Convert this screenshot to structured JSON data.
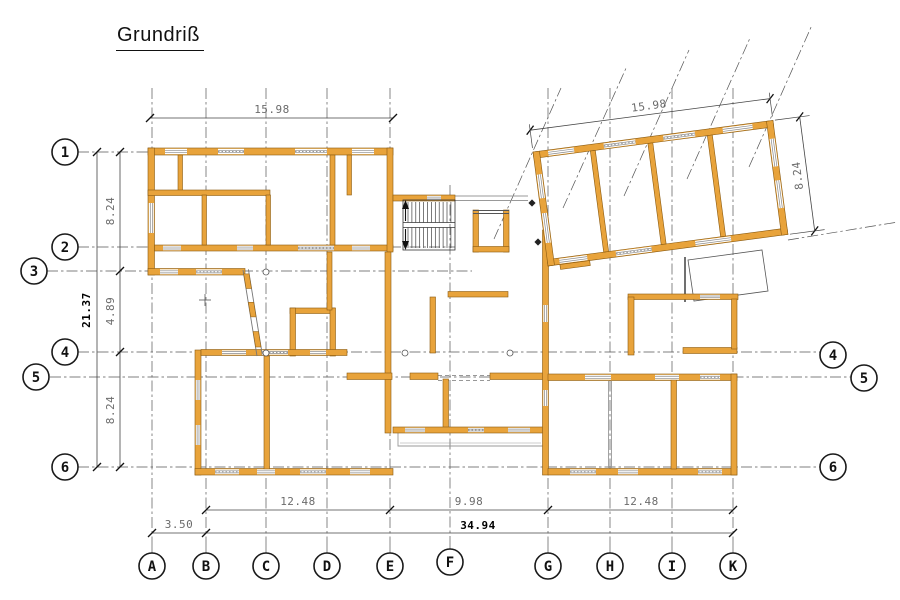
{
  "title": "Grundriß",
  "colors": {
    "wall": "#E8A33B",
    "wall_edge": "#8A5A10",
    "line": "#333333",
    "grid_line": "#555555",
    "dim_line": "#444444",
    "dim_text": "#6B6B6B",
    "total_text": "#000000",
    "thin": "#999999",
    "background": "#FFFFFF"
  },
  "grid": {
    "rows": [
      "1",
      "2",
      "3",
      "4",
      "5",
      "6"
    ],
    "rows_right": [
      "4",
      "5",
      "6"
    ],
    "cols": [
      "A",
      "B",
      "C",
      "D",
      "E",
      "F",
      "G",
      "H",
      "I",
      "K"
    ]
  },
  "dimensions": {
    "top_width": "15.98",
    "left_total": "21.37",
    "left_segments": [
      "8.24",
      "4.89",
      "8.24"
    ],
    "bottom_row1": [
      "12.48",
      "9.98",
      "12.48"
    ],
    "bottom_offset": "3.50",
    "bottom_total": "34.94",
    "wing_width": "15.98",
    "wing_depth": "8.24"
  }
}
